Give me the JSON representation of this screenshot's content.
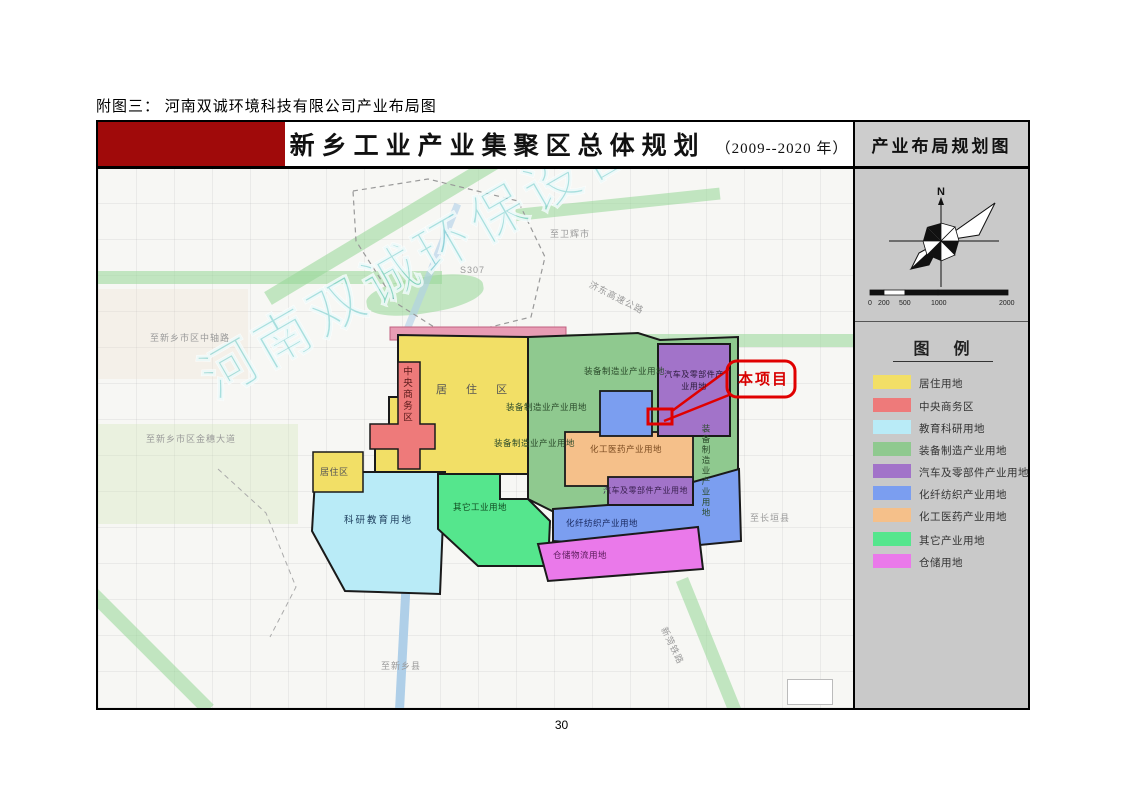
{
  "page": {
    "caption": "附图三： 河南双诚环境科技有限公司产业布局图",
    "page_number": "30"
  },
  "header": {
    "title": "新乡工业产业集聚区总体规划",
    "year_range": "（2009--2020 年）",
    "panel_title": "产业布局规划图"
  },
  "sidebar": {
    "compass_label": "N",
    "scale_ticks": [
      "0",
      "200",
      "500",
      "1000",
      "2000"
    ],
    "legend_title": "图 例",
    "legend_items": [
      {
        "label": "居住用地",
        "color": "#f2df66"
      },
      {
        "label": "中央商务区",
        "color": "#ee7a7a"
      },
      {
        "label": "教育科研用地",
        "color": "#b9ebf7"
      },
      {
        "label": "装备制造产业用地",
        "color": "#8fc98f"
      },
      {
        "label": "汽车及零部件产业用地",
        "color": "#a273c9"
      },
      {
        "label": "化纤纺织产业用地",
        "color": "#7b9ef0"
      },
      {
        "label": "化工医药产业用地",
        "color": "#f5c08a"
      },
      {
        "label": "其它产业用地",
        "color": "#55e68d"
      },
      {
        "label": "仓储用地",
        "color": "#ea79ea"
      }
    ]
  },
  "map": {
    "watermark": "河南双诚环保设备",
    "callout_label": "本项目",
    "callout_color": "#e00000",
    "zone_labels": [
      {
        "text": "中央商务区"
      },
      {
        "text": "居 住 区"
      },
      {
        "text": "装备制造业产业用地"
      },
      {
        "text": "装备制造业产业用地"
      },
      {
        "text": "装备制造业产业用地"
      },
      {
        "text": "化工医药产业用地"
      },
      {
        "text": "汽车及零部件产业用地"
      },
      {
        "text": "化纤纺织产业用地"
      },
      {
        "text": "其它工业用地"
      },
      {
        "text": "仓储物流用地"
      },
      {
        "text": "科研教育用地"
      },
      {
        "text": "居住区"
      },
      {
        "text": "汽车及零部件产业用地"
      },
      {
        "text": "装备制造业产业用地"
      }
    ],
    "road_labels": [
      {
        "text": "至卫辉市"
      },
      {
        "text": "S307"
      },
      {
        "text": "济东高速公路"
      },
      {
        "text": "至新乡市区中轴路"
      },
      {
        "text": "至新乡市区金穗大道"
      },
      {
        "text": "至长垣县"
      },
      {
        "text": "至新乡县"
      },
      {
        "text": "新菏铁路"
      }
    ]
  }
}
